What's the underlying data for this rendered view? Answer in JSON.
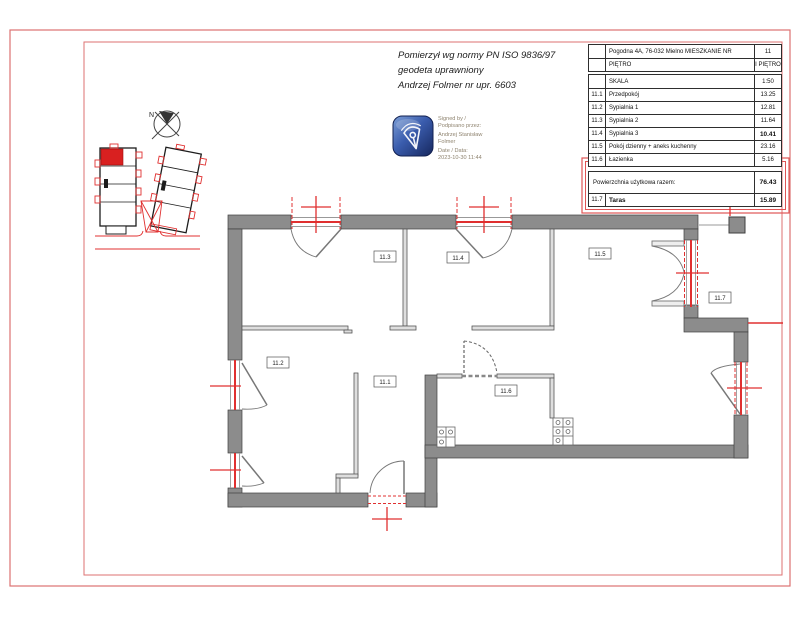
{
  "page": {
    "measure_note": [
      "Pomierzył wg normy  PN ISO 9836/97",
      "geodeta uprawniony",
      "Andrzej Folmer nr upr. 6603"
    ]
  },
  "signature": {
    "lines": [
      "Signed by /",
      "Podpisano przez:",
      "Andrzej Stanisław",
      "Folmer",
      "Date / Data:",
      "2023-10-30 11:44"
    ]
  },
  "table": {
    "address": "Pogodna 4A, 76-032 Mielno MIESZKANIE NR",
    "apartment_no": "11",
    "floor_label": "PIĘTRO",
    "floor_value": "I PIĘTRO",
    "scale_label": "SKALA",
    "scale_value": "1:50",
    "rows": [
      {
        "num": "11.1",
        "name": "Przedpokój",
        "area": "13.25"
      },
      {
        "num": "11.2",
        "name": "Sypialnia 1",
        "area": "12.81"
      },
      {
        "num": "11.3",
        "name": "Sypialnia 2",
        "area": "11.64"
      },
      {
        "num": "11.4",
        "name": "Sypialnia 3",
        "area": "10.41"
      },
      {
        "num": "11.5",
        "name": "Pokój dzienny + aneks kuchenny",
        "area": "23.16"
      },
      {
        "num": "11.6",
        "name": "Łazienka",
        "area": "5.16"
      }
    ],
    "total_label": "Powierzchnia użytkowa razem:",
    "total_value": "76.43",
    "terrace": {
      "num": "11.7",
      "name": "Taras",
      "area": "15.89"
    }
  },
  "plan": {
    "north_label": "N",
    "room_labels": {
      "r113": "11.3",
      "r114": "11.4",
      "r115": "11.5",
      "r112": "11.2",
      "r111": "11.1",
      "r116": "11.6",
      "r117": "11.7"
    }
  },
  "colors": {
    "dim_red": "#e03030",
    "frame_red": "#dd7272",
    "wall_gray": "#8c8c8c",
    "stamp_blue": "#2a4d9b",
    "unit_red": "#d92020"
  }
}
